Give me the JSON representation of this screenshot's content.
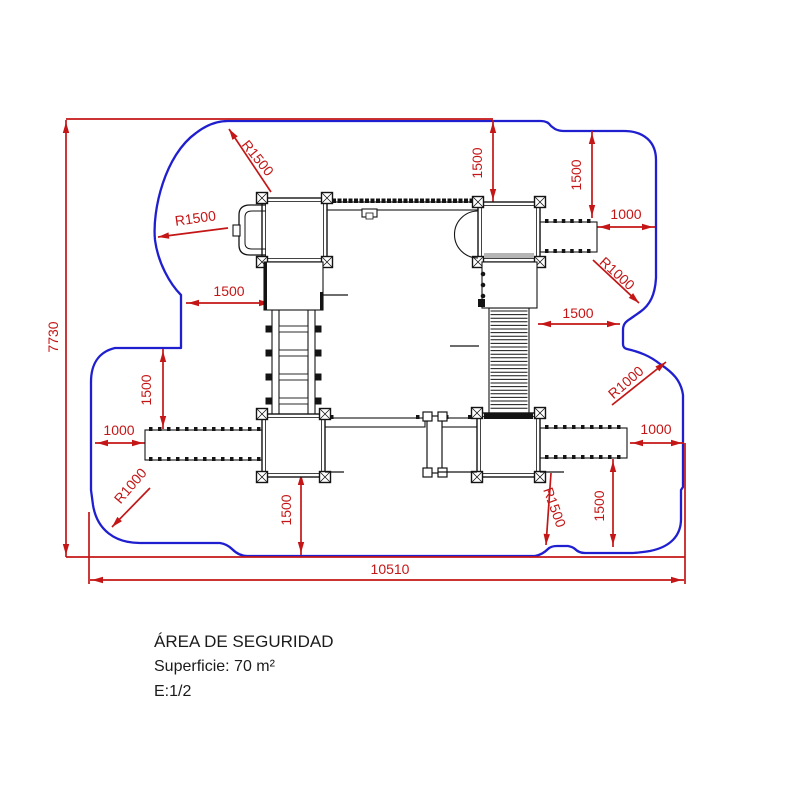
{
  "page": {
    "background": "#ffffff"
  },
  "title_block": {
    "title": "ÁREA DE SEGURIDAD",
    "surface": "Superficie: 70 m²",
    "scale": "E:1/2"
  },
  "dimension_labels": {
    "total_height": "7730",
    "total_width": "10510",
    "radius_top_left_outer": "R1500",
    "radius_top_left_inner": "R1500",
    "offset_top_left": "1500",
    "offset_top_first": "1500",
    "offset_top_second": "1500",
    "offset_top_right": "1000",
    "radius_top_right": "R1000",
    "offset_right_mid": "1500",
    "offset_left_mid": "1500",
    "offset_left": "1000",
    "radius_bottom_left": "R1000",
    "offset_bottom_center": "1500",
    "radius_bottom_right": "R1500",
    "offset_bottom_right": "1500",
    "offset_right_lower": "1000",
    "radius_right": "R1000"
  },
  "colors": {
    "dimension_red": "#c41616",
    "boundary_blue": "#1f1fd0",
    "structure_black": "#141414"
  }
}
